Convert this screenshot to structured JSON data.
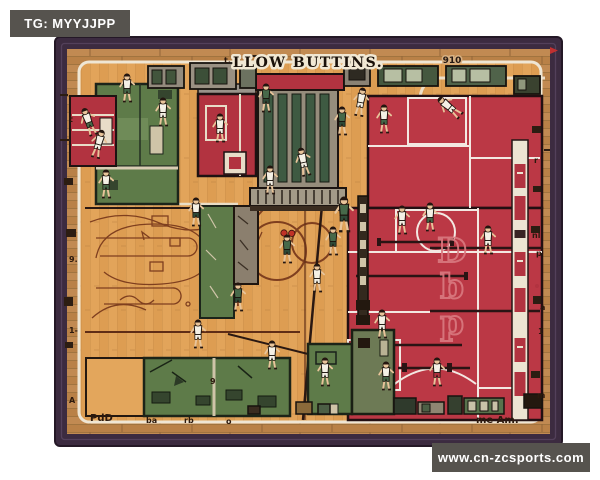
{
  "watermarks": {
    "top_left": "TG: MYYJJPP",
    "bottom_right": "www.cn-zcsports.com"
  },
  "artwork": {
    "title": "LLOW BUTTINS.",
    "corner_text": "910",
    "court_letters": "Dbp",
    "colors": {
      "frame": "#3c2b40",
      "frame_inner": "#57445f",
      "wood_border": "#c18a52",
      "floor": "#e2a45a",
      "room_green": "#5e7b49",
      "room_red": "#b23340",
      "court_red": "#bb3845",
      "line_white": "#efe6d4",
      "line_brown": "#7a3a1c",
      "watermark_bg": "#56534e"
    },
    "glyphs": [
      {
        "x": 224,
        "y": 63,
        "t": "t."
      },
      {
        "x": 90,
        "y": 421,
        "t": "PdD",
        "b": 1
      },
      {
        "x": 146,
        "y": 423,
        "t": "ba"
      },
      {
        "x": 184,
        "y": 423,
        "t": "rb"
      },
      {
        "x": 226,
        "y": 424,
        "t": "o"
      },
      {
        "x": 476,
        "y": 423,
        "t": "me Am.",
        "b": 1
      },
      {
        "x": 534,
        "y": 163,
        "t": "r"
      },
      {
        "x": 532,
        "y": 238,
        "t": "nl"
      },
      {
        "x": 536,
        "y": 256,
        "t": "p"
      },
      {
        "x": 540,
        "y": 310,
        "t": "a"
      },
      {
        "x": 538,
        "y": 334,
        "t": "1"
      },
      {
        "x": 537,
        "y": 398,
        "t": "m"
      },
      {
        "x": 69,
        "y": 122,
        "t": "t"
      },
      {
        "x": 69,
        "y": 262,
        "t": "9."
      },
      {
        "x": 69,
        "y": 333,
        "t": "1-"
      },
      {
        "x": 69,
        "y": 403,
        "t": "A"
      },
      {
        "x": 210,
        "y": 384,
        "t": "9"
      }
    ],
    "players": [
      {
        "x": 127,
        "y": 86,
        "j": "w",
        "s": "g"
      },
      {
        "x": 163,
        "y": 110,
        "j": "w",
        "s": "w"
      },
      {
        "x": 88,
        "y": 120,
        "j": "w",
        "s": "g",
        "r": -20
      },
      {
        "x": 99,
        "y": 142,
        "j": "w",
        "s": "w",
        "r": 15
      },
      {
        "x": 106,
        "y": 182,
        "j": "w",
        "s": "g"
      },
      {
        "x": 220,
        "y": 126,
        "j": "w",
        "s": "w"
      },
      {
        "x": 196,
        "y": 210,
        "j": "w",
        "s": "dg"
      },
      {
        "x": 266,
        "y": 96,
        "j": "g",
        "s": "dg"
      },
      {
        "x": 303,
        "y": 160,
        "j": "w",
        "s": "w",
        "r": -12
      },
      {
        "x": 270,
        "y": 178,
        "j": "w",
        "s": "w"
      },
      {
        "x": 342,
        "y": 119,
        "j": "g",
        "s": "dg"
      },
      {
        "x": 361,
        "y": 100,
        "j": "w",
        "s": "w",
        "r": 10
      },
      {
        "x": 384,
        "y": 117,
        "j": "w",
        "s": "g"
      },
      {
        "x": 448,
        "y": 106,
        "j": "w",
        "s": "w",
        "r": -50
      },
      {
        "x": 344,
        "y": 212,
        "j": "g",
        "s": "dg",
        "sc": 1.3
      },
      {
        "x": 402,
        "y": 218,
        "j": "w",
        "s": "w"
      },
      {
        "x": 430,
        "y": 215,
        "j": "w",
        "s": "g"
      },
      {
        "x": 287,
        "y": 247,
        "j": "g",
        "s": "dg",
        "ball": true
      },
      {
        "x": 238,
        "y": 295,
        "j": "g",
        "s": "dg"
      },
      {
        "x": 317,
        "y": 276,
        "j": "w",
        "s": "w"
      },
      {
        "x": 333,
        "y": 239,
        "j": "g",
        "s": "dg"
      },
      {
        "x": 198,
        "y": 332,
        "j": "w",
        "s": "w"
      },
      {
        "x": 272,
        "y": 353,
        "j": "w",
        "s": "w"
      },
      {
        "x": 325,
        "y": 370,
        "j": "w",
        "s": "w"
      },
      {
        "x": 382,
        "y": 322,
        "j": "w",
        "s": "w"
      },
      {
        "x": 386,
        "y": 374,
        "j": "w",
        "s": "g"
      },
      {
        "x": 437,
        "y": 370,
        "j": "w",
        "s": "r"
      },
      {
        "x": 488,
        "y": 238,
        "j": "w",
        "s": "w"
      }
    ]
  }
}
